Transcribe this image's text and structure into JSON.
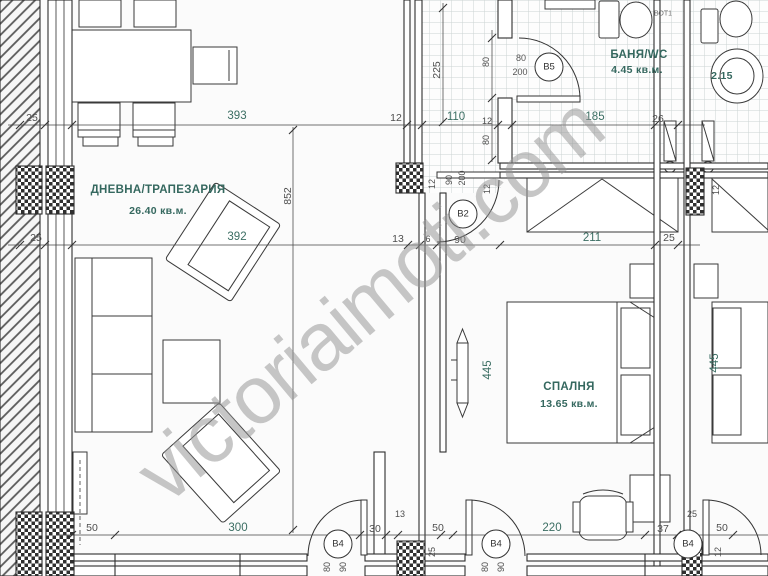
{
  "watermark": "victoriaimoti.com",
  "rooms": {
    "living": {
      "name": "ДНЕВНА/ТРАПЕЗАРИЯ",
      "area": "26.40 кв.м."
    },
    "bedroom": {
      "name": "СПАЛНЯ",
      "area": "13.65 кв.м."
    },
    "bathroom": {
      "name": "БАНЯ/WC",
      "area": "4.45 кв.м."
    },
    "adjacent_wc": {
      "area": "2.15"
    },
    "note": "ВОТ1"
  },
  "doors": {
    "b5": "В5",
    "b2": "В2",
    "b4l": "В4",
    "b4r": "В4",
    "b4a": "В4"
  },
  "door_specs": {
    "b5_w": "80",
    "b5_h": "200"
  },
  "dims": {
    "top": [
      "25",
      "393",
      "12",
      "110",
      "12",
      "185",
      "26"
    ],
    "mid": [
      "25",
      "392",
      "13",
      "6",
      "90",
      "211",
      "25"
    ],
    "bottom": [
      "50",
      "300",
      "30",
      "13",
      "50",
      "220",
      "37",
      "25",
      "50"
    ],
    "v": {
      "living_height": "852",
      "hall_height": "225",
      "bath_door_a": "80",
      "bath_door_b": "80",
      "b2_wall_l": "12",
      "b2_w": "90",
      "b2_h": "200",
      "b2_wall_r": "12",
      "wall12_right": "12",
      "col25": "25",
      "wall12_bottom": "12",
      "b4l_a": "80",
      "b4l_b": "90",
      "b4r_a": "80",
      "b4r_b": "90",
      "rad445_a": "445",
      "rad445_b": "445"
    }
  },
  "colors": {
    "accent_teal": "#3b6e63",
    "line": "#2e2e2e"
  }
}
